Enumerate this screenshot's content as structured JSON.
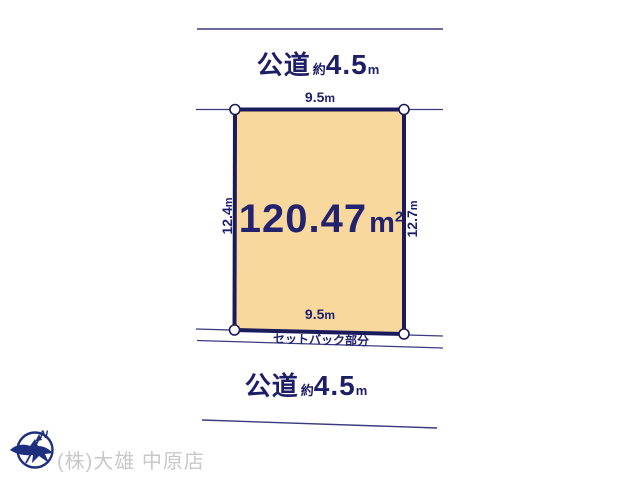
{
  "colors": {
    "background": "#ffffff",
    "plot_fill": "#f8d89c",
    "plot_border": "#1a1a5c",
    "thin_line": "#3a3a80",
    "text_navy": "#1e1e6e",
    "company_gray": "#c8c8c8",
    "logo_blue": "#1d2f7e"
  },
  "top_road": {
    "name": "公道",
    "approx": "約",
    "width": "4.5",
    "unit": "m"
  },
  "bottom_road": {
    "name": "公道",
    "approx": "約",
    "width": "4.5",
    "unit": "m"
  },
  "plot": {
    "area_value": "120.47",
    "area_unit": "m",
    "area_exponent": "2",
    "top_width_value": "9.5",
    "top_width_unit": "m",
    "bottom_width_value": "9.5",
    "bottom_width_unit": "m",
    "left_depth_value": "12.4",
    "left_depth_unit": "m",
    "right_depth_value": "12.7",
    "right_depth_unit": "m",
    "setback_label": "セットバック部分"
  },
  "footer": {
    "company_name": "(株)大雄 中原店",
    "compass_north": "N"
  }
}
